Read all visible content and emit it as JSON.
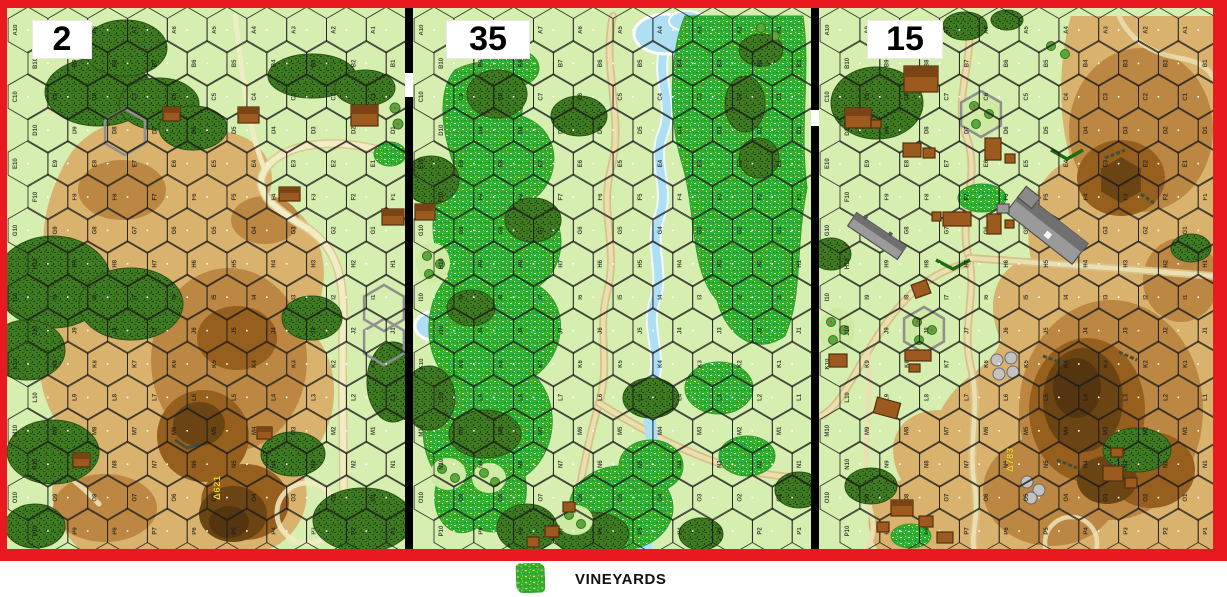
{
  "app": "hex-wargame map viewer",
  "boards": [
    {
      "id": "board-2",
      "number": "2",
      "hill_label": "Δ621",
      "features": [
        "woods",
        "multi-level brown hills",
        "scattered buildings",
        "pale trails",
        "stone-walled hexes",
        "small vineyard and orchard at east edge"
      ]
    },
    {
      "id": "board-35",
      "number": "35",
      "hill_label": "",
      "features": [
        "large vineyard belts",
        "meandering stream with ponds",
        "woods",
        "orchards",
        "tan road",
        "few small buildings"
      ]
    },
    {
      "id": "board-15",
      "number": "15",
      "hill_label": "Δ783",
      "features": [
        "village with brown and gray stone buildings",
        "church",
        "orchards",
        "vineyard patch",
        "tan roads",
        "large multi-level hill mass with crags",
        "stone circles"
      ]
    }
  ],
  "hex_grid": {
    "rows": "ABCDEFGHIJKLMNOP",
    "columns": 10,
    "numbering": "10 at left edge to 1 at right edge",
    "label_rotation_deg": -90,
    "center_dot_color": "#ffffff"
  },
  "legend": {
    "label": "VINEYARDS",
    "swatch": "vineyards-texture"
  },
  "palette": {
    "frame_red": "#e8191f",
    "separator_black": "#000000",
    "base_green": "#d6eeb0",
    "woods_green": "#3e7a22",
    "vineyard_green": "#33ae33",
    "vineyard_speckle_yellow": "#ffec3d",
    "orchard_pale": "#cfeaa2",
    "hill_level1": "#d9b36e",
    "hill_level2": "#bb8742",
    "hill_level3": "#965f1e",
    "hill_level4": "#6b4414",
    "hill_level5": "#553510",
    "water_blue": "#aedff2",
    "road_tan_casing": "#d7c186",
    "road_tan_core": "#eadfb0",
    "road_pale": "#f2ecc4",
    "building_brown": "#9c5a1e",
    "building_gray": "#9a9a9a",
    "hex_line": "#1c1c1c",
    "hill_label_yellow": "#ead32b",
    "label_box_white": "#ffffff"
  }
}
